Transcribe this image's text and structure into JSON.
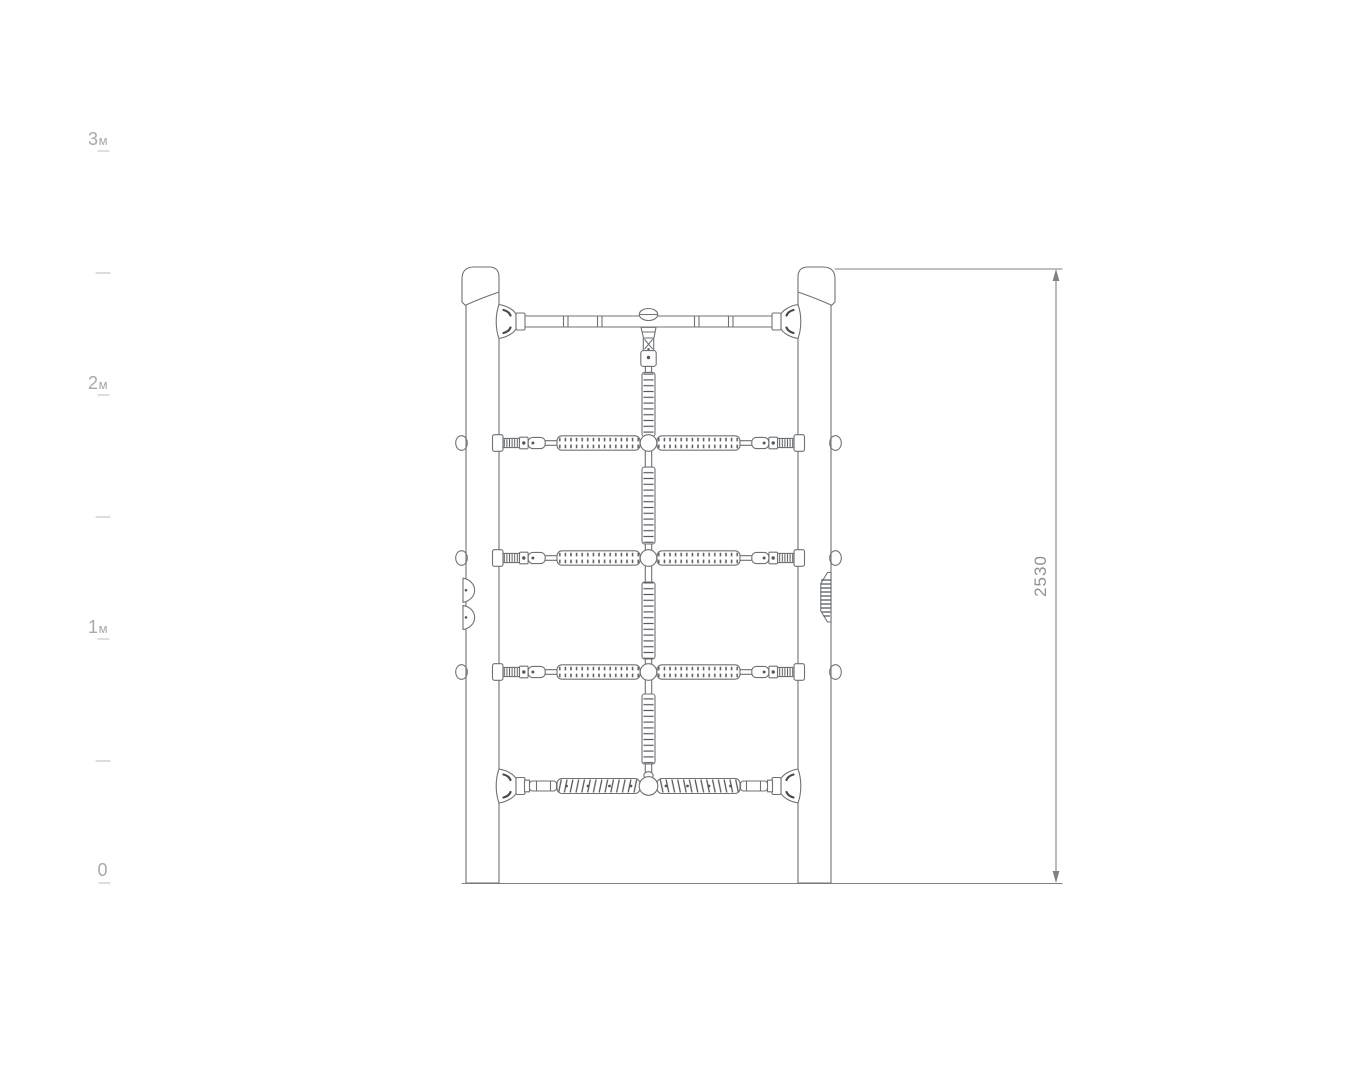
{
  "scale": {
    "labels": [
      {
        "num": "3",
        "unit": "м"
      },
      {
        "num": "2",
        "unit": "м"
      },
      {
        "num": "1",
        "unit": "м"
      },
      {
        "num": "0",
        "unit": ""
      }
    ]
  },
  "dimension": {
    "height_mm": "2530"
  },
  "colors": {
    "line": "#6e7276",
    "rib": "#55595d",
    "tick": "#c6cacd",
    "scale_text": "#a4a9ae",
    "dimension": "#7d8286"
  }
}
